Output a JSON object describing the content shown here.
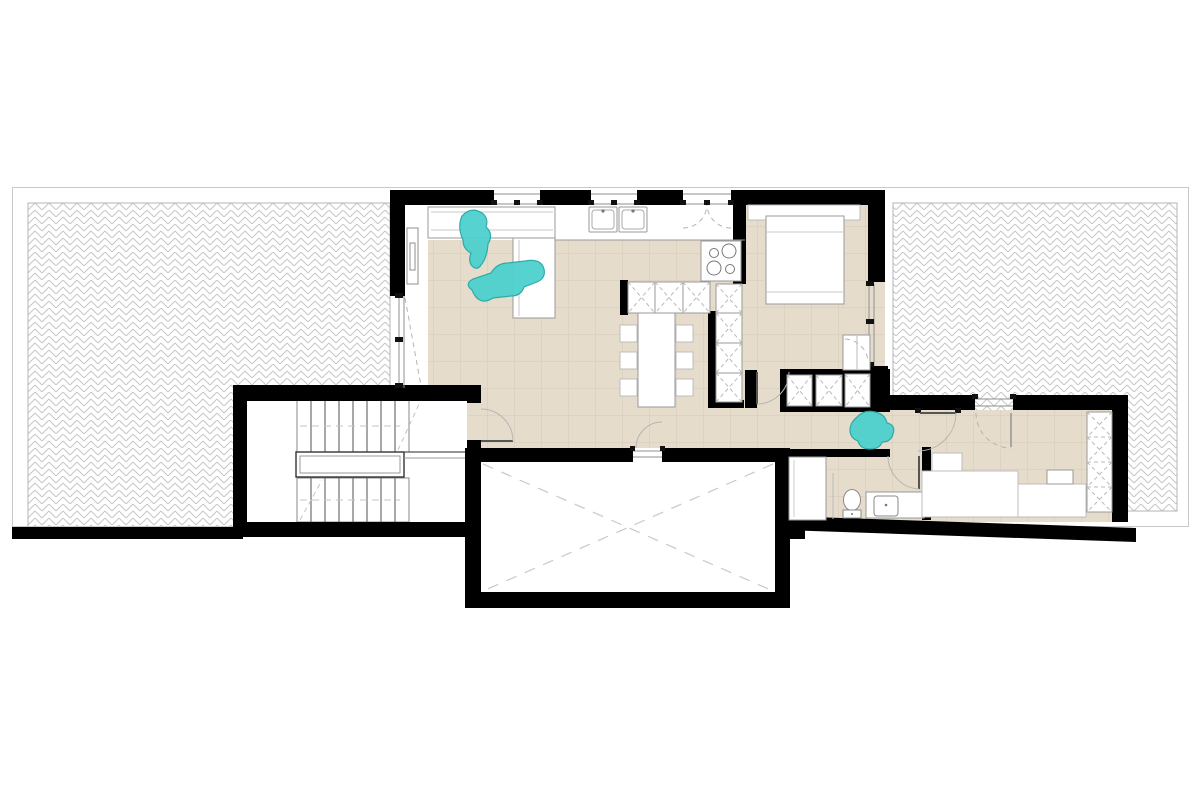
{
  "document": {
    "kind": "architectural-floor-plan",
    "visible_text": []
  },
  "colors": {
    "paper": "#ffffff",
    "wall": "#000000",
    "floor_tile": "#e6dccb",
    "floor_tile_line": "#d5c8b5",
    "hatch_line": "#c6c6c6",
    "hatch_border": "#b5b5b5",
    "outer_border": "#c9c9c9",
    "furniture_line": "#9a9a9a",
    "dash_line": "#b9b9b9",
    "arc_line": "#b5b5b5",
    "person_fill": "#4ed1ce",
    "person_edge": "#23a8a6"
  },
  "plan": {
    "zones": [
      {
        "name": "left-terrace",
        "surface": "herringbone-hatch"
      },
      {
        "name": "right-terrace",
        "surface": "herringbone-hatch"
      },
      {
        "name": "stair-hall",
        "surface": "plain"
      },
      {
        "name": "living-kitchen-dining",
        "surface": "beige-tile"
      },
      {
        "name": "bedroom-1",
        "surface": "beige-tile"
      },
      {
        "name": "corridor",
        "surface": "beige-tile"
      },
      {
        "name": "bathroom",
        "surface": "beige-tile"
      },
      {
        "name": "bedroom-2",
        "surface": "beige-tile"
      },
      {
        "name": "double-height-void",
        "surface": "white-dashed-x"
      }
    ],
    "fixtures": [
      "u-shaped-staircase",
      "l-shaped-sofa",
      "kitchen-counter",
      "double-sink",
      "cooktop-4-burners",
      "kitchen-island-unit",
      "tall-cabinet-column",
      "dining-table-6-chairs",
      "double-bed",
      "bedside-cabinet",
      "wardrobe-row",
      "shower",
      "toilet",
      "washbasin-vanity",
      "desk-bed-unit",
      "wardrobe-column",
      "pocket-door",
      "sliding-glass-door",
      "double-swing-terrace-doors",
      "window-strips"
    ],
    "people": [
      {
        "name": "person-sitting-on-sofa"
      },
      {
        "name": "person-lounging-on-sofa"
      },
      {
        "name": "person-sitting-in-corridor"
      }
    ]
  }
}
